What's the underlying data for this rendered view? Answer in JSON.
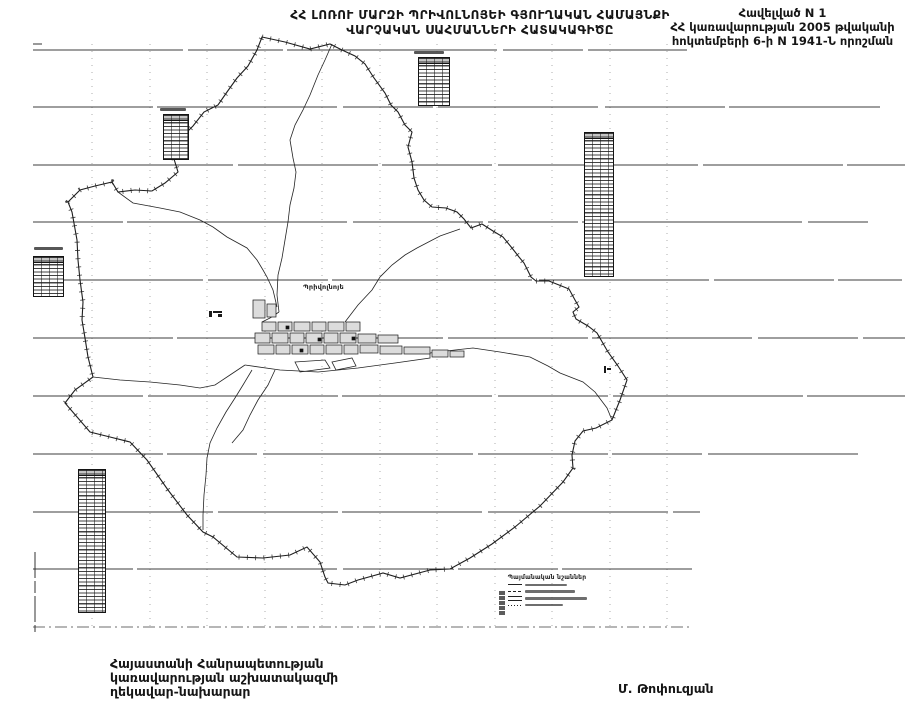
{
  "doc": {
    "title_line1": "ՀՀ ԼՈՌՈՒ ՄԱՐԶԻ ՊՐԻՎՈԼՆՈՅԵԻ ԳՅՈՒՂԱԿԱՆ ՀԱՄԱՅՆՔԻ",
    "title_line2": "ՎԱՐՉԱԿԱՆ ՍԱՀՄԱՆՆԵՐԻ ՀԱՏԱԿԱԳԻԾԸ"
  },
  "annex_note": {
    "line1": "Հավելված N 1",
    "line2": "ՀՀ կառավարության 2005 թվականի",
    "line3": "հոկտեմբերի 6-ի N 1941-Ն որոշման"
  },
  "map": {
    "settlement_label": "Պրիվոլնոյե",
    "legend_title": "Պայմանական նշաններ"
  },
  "signature": {
    "line1": "Հայաստանի Հանրապետության",
    "line2": "կառավարության աշխատակազմի",
    "line3": "ղեկավար-նախարար",
    "name": "Մ. Թոփուզյան"
  },
  "colors": {
    "ink": "#1a1a1a",
    "grid_line": "#3c3c3c",
    "faint_grid": "#9a9a9a",
    "block_fill": "#dcdcdc"
  }
}
